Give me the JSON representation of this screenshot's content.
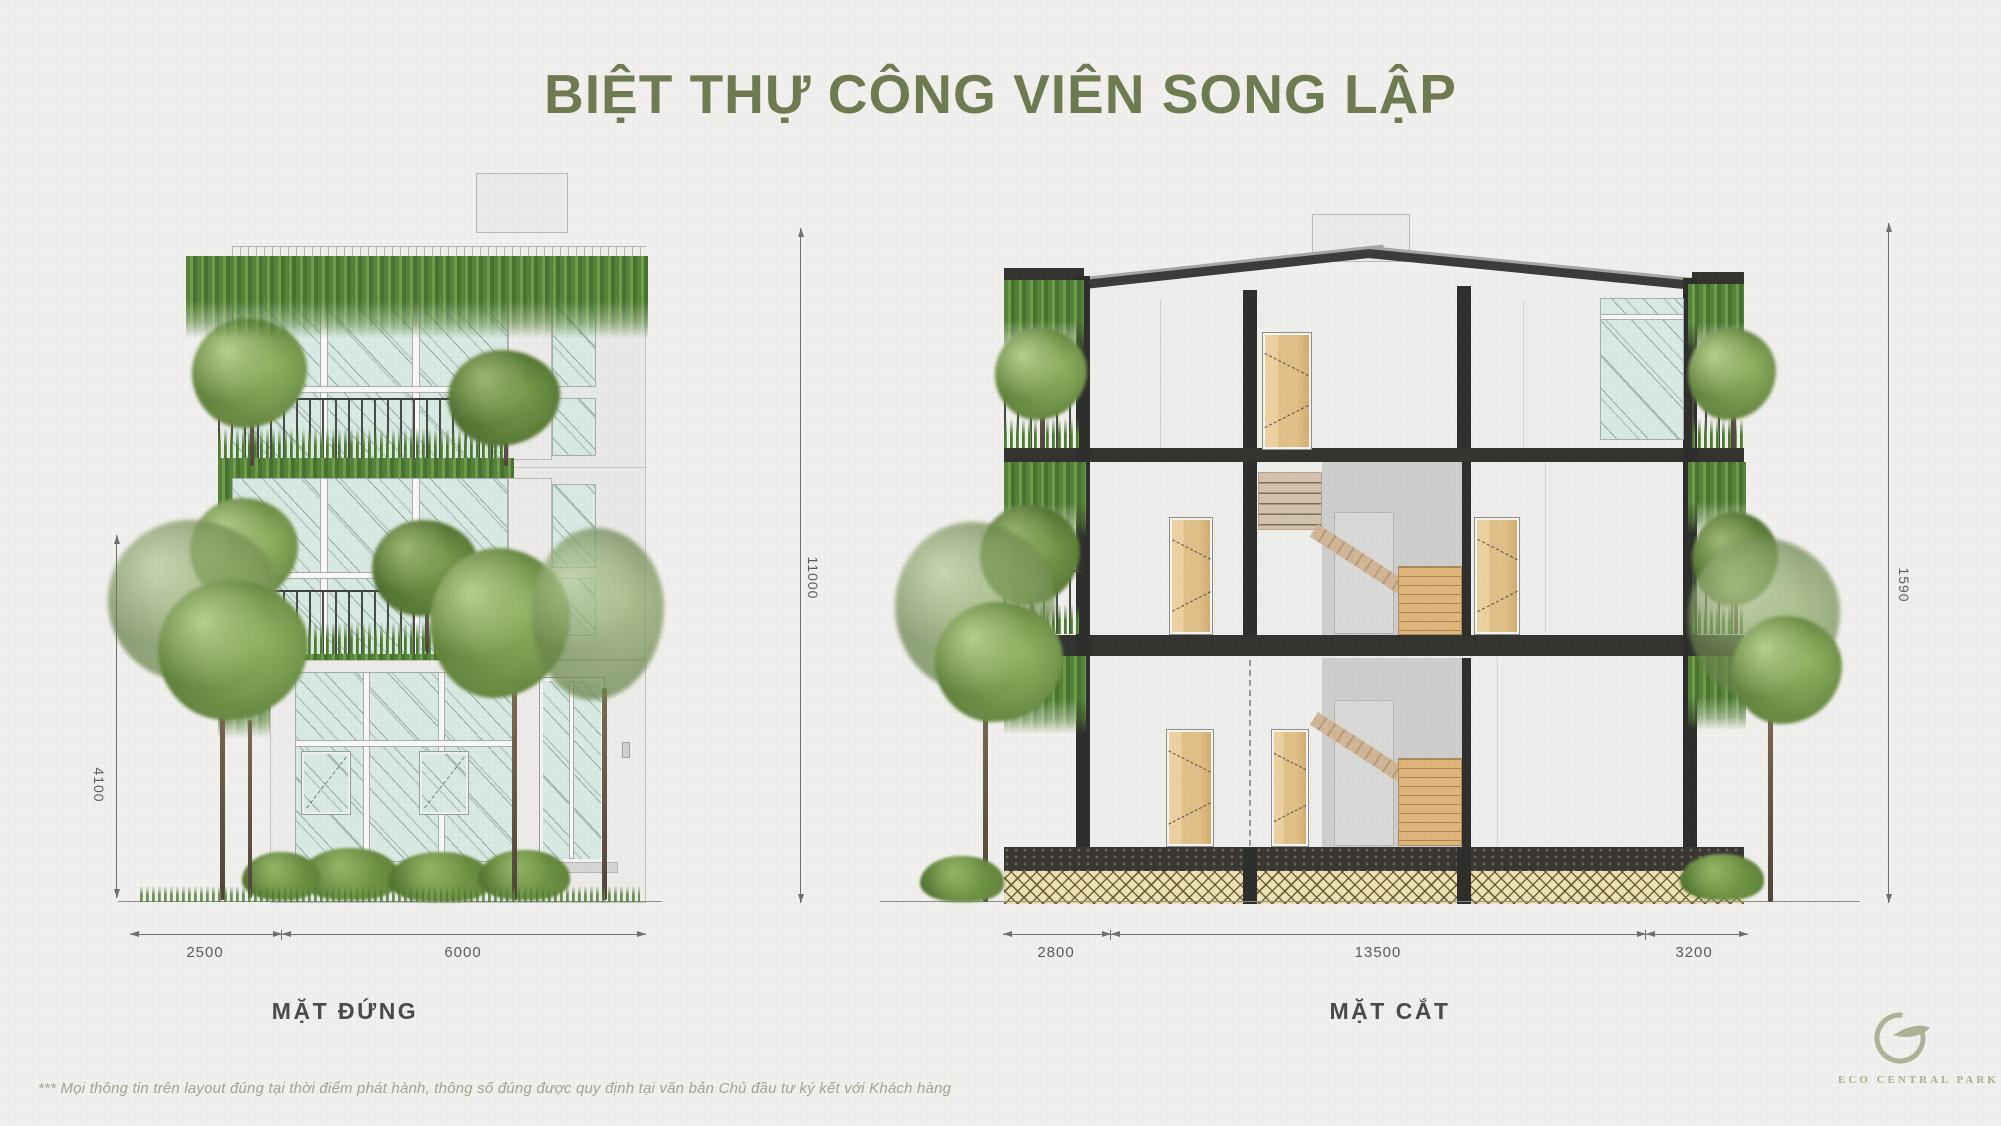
{
  "title": {
    "text": "BIỆT THỰ CÔNG VIÊN SONG LẬP"
  },
  "elevation": {
    "label": "MẶT ĐỨNG",
    "dims": {
      "bottom": [
        "2500",
        "6000"
      ],
      "side_height": "4100",
      "total_height": "11000"
    }
  },
  "section": {
    "label": "MẶT CẮT",
    "dims": {
      "bottom": [
        "2800",
        "13500",
        "3200"
      ],
      "side_height": "1590"
    }
  },
  "footer": {
    "disclaimer": "*** Mọi thông tin trên layout đúng tại thời điểm phát hành, thông số đúng được quy định tại văn bản Chủ đầu tư ký kết với Khách hàng"
  },
  "logo": {
    "text": "ECO CENTRAL PARK",
    "icon": "eco-leaf-e-icon"
  },
  "colors": {
    "background": "#f0efed",
    "title_green": "#6e7b50",
    "label_gray": "#4a4a4a",
    "dim_gray": "#6f6f6f",
    "glass_tint": "#d7e9e2",
    "plant_green": "#5f8c3a",
    "wood_tan": "#e0bd8a",
    "structure_dark": "#333330",
    "logo_sage": "#a9ae94"
  }
}
